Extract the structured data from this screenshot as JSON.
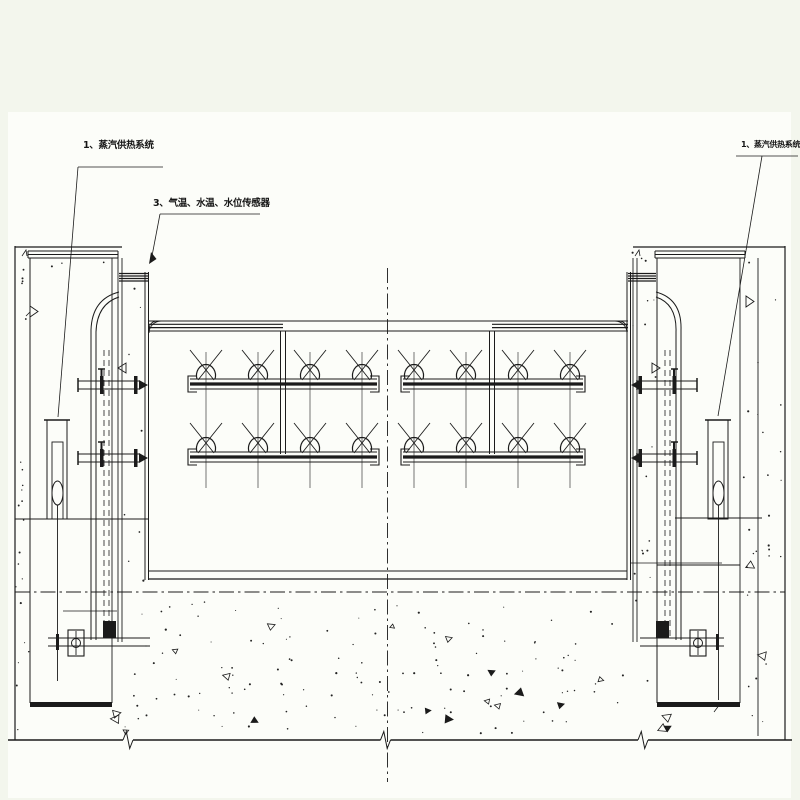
{
  "annotations": {
    "steam_supply_left": "1、蒸汽供热系统",
    "sensors": "3、气温、水温、水位传感器",
    "steam_supply_right": "1、蒸汽供热系统"
  },
  "colors": {
    "line": "#1b1b1b",
    "thin_line": "#3a3a3a",
    "page_background": "#fcfdf9",
    "margin_background": "#f3f6ed"
  }
}
